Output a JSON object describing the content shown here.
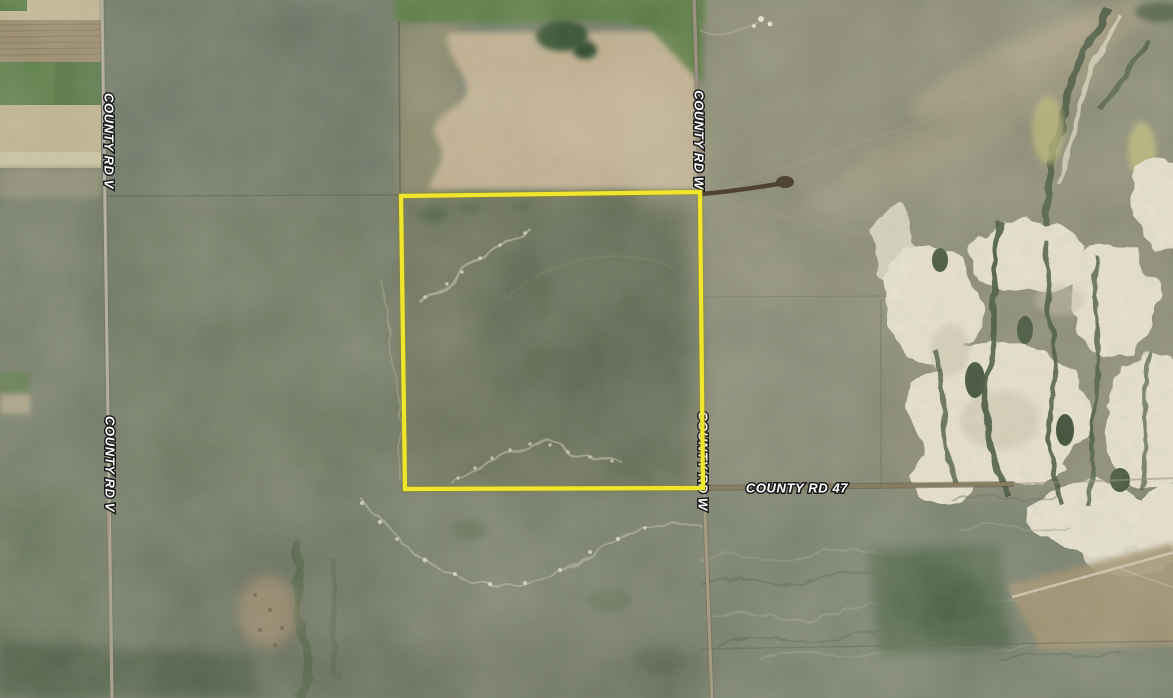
{
  "app": {
    "name": "satellite-map-view"
  },
  "map": {
    "imagery": "satellite",
    "labels": {
      "county_rd_v_north": "COUNTY RD V",
      "county_rd_v_south": "COUNTY RD V",
      "county_rd_w_north": "COUNTY RD W",
      "county_rd_w_south": "COUNTY RD W",
      "county_rd_47": "COUNTY RD 47"
    },
    "boundary": {
      "color": "#f0e72c",
      "corners_px": [
        [
          401,
          196
        ],
        [
          700,
          192
        ],
        [
          703,
          488
        ],
        [
          405,
          489
        ]
      ]
    },
    "label_style": {
      "color": "#ffffff",
      "halo": "#1b1b1b"
    },
    "palette": {
      "terrain_base": "#737968",
      "farm_green": "#5b7f48",
      "farm_tan": "#c1b592",
      "bare_field_tan": "#c2b092",
      "badlands_cream": "#e9e3d0",
      "juniper_green": "#3e4f37",
      "road_gray": "#b6b0a1",
      "road_brown": "#867d63"
    }
  }
}
